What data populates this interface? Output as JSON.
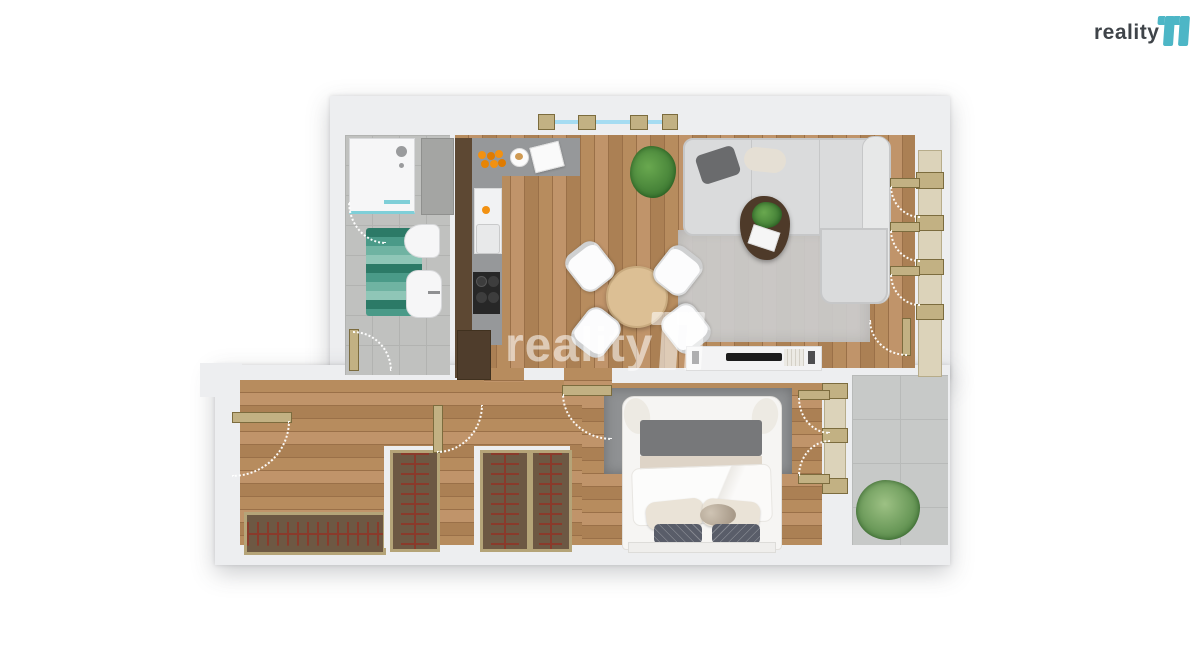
{
  "branding": {
    "logo_text": "reality",
    "logo_mark": "11",
    "watermark_text": "reality",
    "watermark_mark": "11"
  },
  "palette": {
    "wall": "#edeef0",
    "wood-a": "#b78c5e",
    "wood-b": "#c0946a",
    "wood-c": "#ab8054",
    "wood-line": "#9a7048",
    "bath-tile": "#c0c1bf",
    "grout": "#b2b3b1",
    "balcony-tile": "#c7c9c8",
    "balcony-grout": "#b8bab9",
    "counter": "#96989a",
    "cooktop": "#272727",
    "teal-a": "#2c7a67",
    "teal-b": "#4a9a88",
    "teal-c": "#6fb3a2",
    "teal-d": "#8fc6b7",
    "sofa": "#dadbdc",
    "sofa-edge": "#c6c7c8",
    "rug-living": "#cbcccd",
    "rug-bedroom": "#8f9193",
    "table-wood": "#dcbf94",
    "coffee-table": "#4e3a29",
    "wardrobe": "#6d5843",
    "wardrobe-frame": "#b5a478",
    "rail": "#8a3a2b",
    "frame": "#c2b183",
    "frame-border": "#7c6c3e",
    "glass-band": "#dcd3ba",
    "glass-blue": "#a5dcf2",
    "plant-a": "#3e7a33",
    "plant-b": "#69a84f",
    "white-furn": "#f6f6f7",
    "blanket": "#ded4c7",
    "bed-band": "#77787a",
    "pillow": "#eae3d7",
    "dark-pillow": "#595d69",
    "brand-teal": "#4db6c6",
    "brand-dark": "#3f4449",
    "wm": "rgba(255,255,255,0.55)"
  },
  "floorplan": {
    "type": "apartment-top-down-render",
    "rooms": [
      {
        "name": "bathroom",
        "features": [
          "shower",
          "shower-head",
          "duct-shaft",
          "toilet",
          "sink",
          "teal-bath-mat",
          "door"
        ]
      },
      {
        "name": "kitchen",
        "features": [
          "l-shaped-counter",
          "fruit-bowl",
          "breakfast-plate",
          "magazine",
          "fridge",
          "sink",
          "cooktop",
          "tall-cabinets"
        ]
      },
      {
        "name": "living-dining-room",
        "features": [
          "window",
          "potted-plant",
          "round-dining-table",
          "four-chairs",
          "corner-sofa",
          "throw-pillows",
          "coffee-table",
          "area-rug",
          "tv-sideboard",
          "french-door-facade"
        ]
      },
      {
        "name": "bedroom",
        "features": [
          "double-bed",
          "pillows",
          "cat",
          "area-rug",
          "balcony-double-door",
          "door"
        ]
      },
      {
        "name": "hallway",
        "features": [
          "entrance-door",
          "low-wardrobe",
          "built-in-wardrobe-1",
          "built-in-wardrobe-2",
          "built-in-wardrobe-3",
          "closet-door"
        ]
      },
      {
        "name": "balcony",
        "features": [
          "tiled-floor",
          "potted-plant"
        ]
      }
    ]
  }
}
